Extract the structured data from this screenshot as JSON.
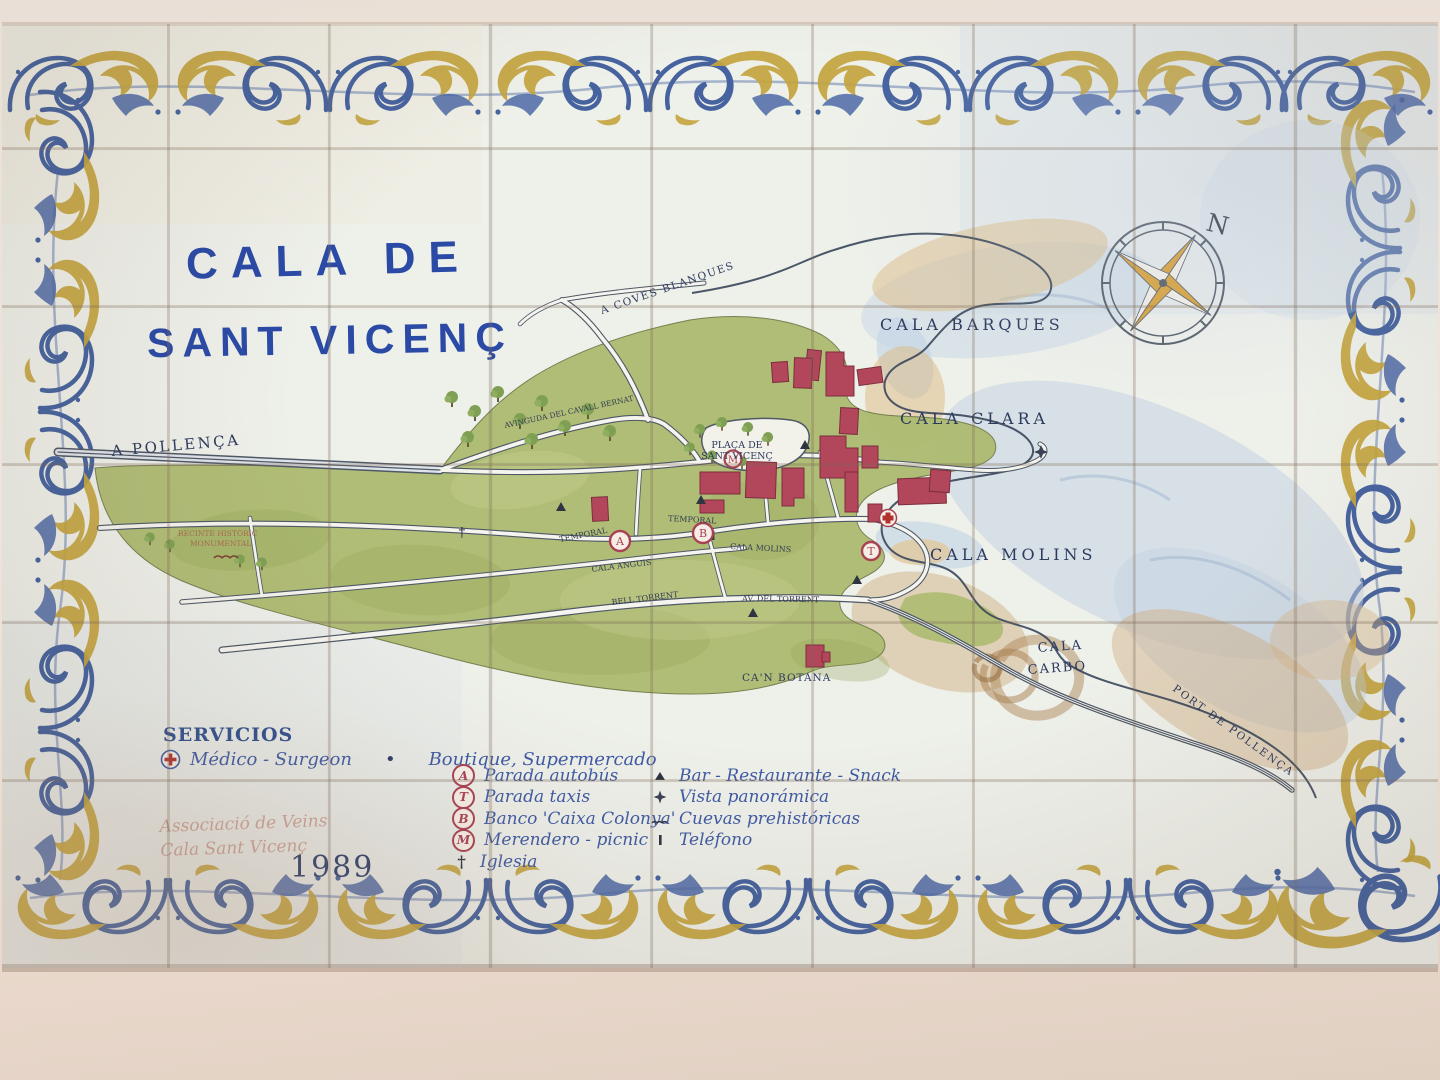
{
  "title": {
    "line1": "CALA DE",
    "line2": "SANT VICENÇ"
  },
  "compass": {
    "north_label": "N"
  },
  "map": {
    "place_labels": {
      "a_pollenca": "A POLLENÇA",
      "a_coves_blanques": "A COVES BLANQUES",
      "cala_barques": "CALA BARQUES",
      "cala_clara": "CALA CLARA",
      "cala_molins_bay": "CALA MOLINS",
      "cala_carbo_line1": "CALA",
      "cala_carbo_line2": "CARBO",
      "port_de_pollenca": "PORT DE POLLENÇA",
      "placa_line1": "PLAÇA DE",
      "placa_line2": "SANT VICENÇ",
      "can_botana": "CA'N BOTANA",
      "recinte_line1": "RECINTE HISTÒRIC",
      "recinte_line2": "MONUMENTAL"
    },
    "street_labels": {
      "av_cavall_bernat": "AVINGUDA DEL CAVALL BERNAT",
      "temporal_west": "TEMPORAL",
      "temporal_east": "TEMPORAL",
      "cala_molins_street": "CALA MOLINS",
      "cala_anguis": "CALA ANGUIS",
      "bell_torrent": "BELL TORRENT",
      "av_del_torrent": "AV. DEL TORRENT"
    },
    "markers": {
      "bus": "A",
      "taxi": "T",
      "bank": "B",
      "picnic": "M",
      "church": "†"
    }
  },
  "legend": {
    "heading": "SERVICIOS",
    "medico_label": "Médico - Surgeon",
    "separator": "•",
    "boutique_label": "Boutique, Supermercado",
    "items_left": [
      {
        "icon": "bus-stop-icon",
        "symbol": "A",
        "label": "Parada autobús"
      },
      {
        "icon": "taxi-stop-icon",
        "symbol": "T",
        "label": "Parada taxis"
      },
      {
        "icon": "bank-icon",
        "symbol": "B",
        "label": "Banco 'Caixa Colonya'"
      },
      {
        "icon": "picnic-icon",
        "symbol": "M",
        "label": "Merendero - picnic"
      },
      {
        "icon": "church-icon",
        "symbol": "†",
        "label": "Iglesia"
      }
    ],
    "items_right": [
      {
        "icon": "bar-icon",
        "symbol": "▲",
        "label": "Bar - Restaurante - Snack"
      },
      {
        "icon": "viewpoint-icon",
        "symbol": "✦",
        "label": "Vista panorámica"
      },
      {
        "icon": "caves-icon",
        "symbol": "∩∩∩",
        "label": "Cuevas prehistóricas"
      },
      {
        "icon": "phone-icon",
        "symbol": "❙",
        "label": "Teléfono"
      }
    ]
  },
  "signature": {
    "line1": "Associació de Veins",
    "line2": "Cala Sant Vicenç",
    "year": "1989"
  },
  "colors": {
    "title_blue": "#2a4aa6",
    "map_label_blue": "#2c3a5e",
    "land_green": "#adbb70",
    "building_red": "#b2465a",
    "sea_blue": "#bfd0e2",
    "beach_tan": "#dbb97f",
    "border_blue": "#46639f",
    "border_yellow": "#c3a43e",
    "wall_pink": "#eadfd6"
  }
}
